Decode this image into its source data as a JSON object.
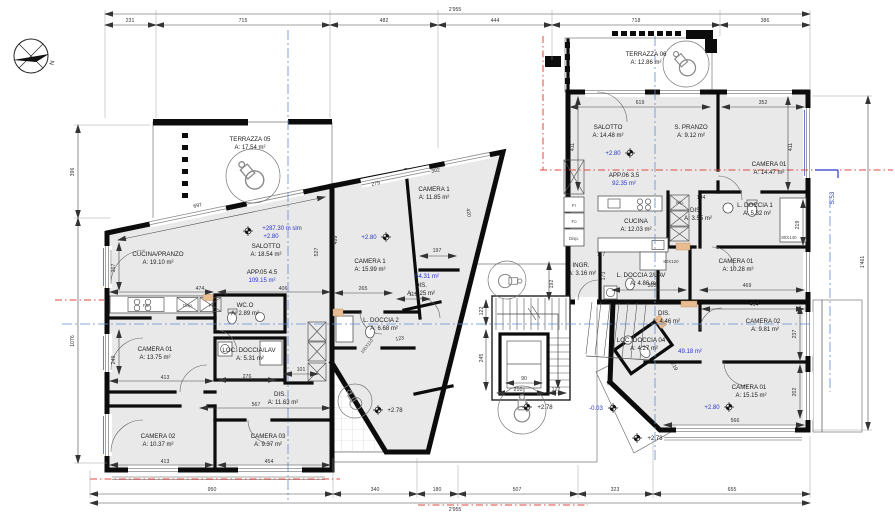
{
  "compass": {
    "north": "N"
  },
  "section": {
    "label": "S.53"
  },
  "overall": {
    "top": "2'955",
    "bottom": "2'955",
    "right": "1'461"
  },
  "dims_top": [
    "231",
    "715",
    "482",
    "444",
    "718",
    "386"
  ],
  "dims_bottom": [
    "950",
    "340",
    "180",
    "507",
    "323",
    "655"
  ],
  "dims_left": [
    "396",
    "1076"
  ],
  "idims": [
    "474",
    "406",
    "697",
    "527",
    "499",
    "413",
    "276",
    "101",
    "567",
    "413",
    "454",
    "279",
    "302",
    "420",
    "197",
    "265",
    "119",
    "123",
    "192",
    "245",
    "122",
    "90",
    "210",
    "122",
    "619",
    "352",
    "411",
    "411",
    "104",
    "117",
    "173",
    "305",
    "469",
    "219",
    "414",
    "237",
    "566",
    "202",
    "219",
    "249",
    "367"
  ],
  "sizes": [
    "80X140",
    "80X120",
    "100X110"
  ],
  "app05": {
    "terrazza": {
      "name": "TERRAZZA 05",
      "area": "A:    17.54 m²"
    },
    "cucina_pranzo": {
      "name": "CUCINA/PRANZO",
      "area": "A:        19.10 m²"
    },
    "salotto": {
      "name": "SALOTTO",
      "area": "A: 18.54 m²"
    },
    "unit_label": "APP.05  4.5",
    "unit_area": "109.15 m²",
    "wc": {
      "name": "WC.O",
      "area": "A: 2.89 m²"
    },
    "loc_doccia": {
      "name": "LOC. DOCCIA/LAV",
      "area": "A:    5.31 m²"
    },
    "camera01": {
      "name": "CAMERA 01",
      "area": "A:  13.75 m²"
    },
    "dis": {
      "name": "DIS.",
      "area": "A: 11.63 m²"
    },
    "camera02": {
      "name": "CAMERA 02",
      "area": "A:  10.37 m²"
    },
    "camera03": {
      "name": "CAMERA 03",
      "area": "A:  9.37 m²"
    },
    "kitchen": [
      "Fo.",
      "Disp.",
      "Fr"
    ]
  },
  "mid": {
    "camera1_top": {
      "name": "CAMERA 1",
      "area": "A: 11.85 m²"
    },
    "camera1_left": {
      "name": "CAMERA 1",
      "area": "A: 15.99 m²"
    },
    "unit_area": "54.31 m²",
    "dis": {
      "name": "DIS.",
      "area": "A: 4.25 m²"
    },
    "doccia": {
      "name": "L. DOCCIA 2",
      "area": "A:    6.68 m²"
    }
  },
  "app06": {
    "terrazza": {
      "name": "TERRAZZA 06",
      "area": "A:    12.86 m²"
    },
    "salotto": {
      "name": "SALOTTO",
      "area": "A: 14.48 m²"
    },
    "s_pranzo": {
      "name": "S. PRANZO",
      "area": "A:    9.12 m²"
    },
    "camera01_top": {
      "name": "CAMERA 01",
      "area": "A:   14.47 m²"
    },
    "unit_label": "APP.06  3.5",
    "unit_area": "92.35 m²",
    "cucina": {
      "name": "CUCINA",
      "area": "A: 12.03 m²"
    },
    "dis": {
      "name": "DIS.",
      "area": "A: 3.55 m²"
    },
    "doccia1": {
      "name": "L. DOCCIA 1",
      "area": "A:    5.32 m²"
    },
    "camera01_mid": {
      "name": "CAMERA 01",
      "area": "A:   10.28 m²"
    },
    "ingr": {
      "name": "INGR.",
      "area": "A: 3.16 m²"
    },
    "doccia2": {
      "name": "L. DOCCIA 2/LAV",
      "area": "A:    4.86 m²"
    },
    "kitchen": [
      "Fr",
      "Fo",
      "Disp."
    ],
    "rip": "Rip."
  },
  "app07": {
    "dis": {
      "name": "DIS.",
      "area": "A: 4.46 m²"
    },
    "camera02": {
      "name": "CAMERA 02",
      "area": "A:    9.81 m²"
    },
    "loc_doccia": {
      "name": "LOC. DOCCIA 04",
      "area": "A:        4.27 m²"
    },
    "unit_area": "49.18 m²",
    "camera01": {
      "name": "CAMERA 01",
      "area": "A:   15.15 m²"
    }
  },
  "levels": {
    "main": "+287.30 m slm",
    "l05": "+2.80",
    "lmid": "+2.80",
    "l06": "+2.80",
    "l07": "+2.80",
    "c1": "+2.78",
    "c2": "-0.03",
    "c3": "+2.78",
    "c4": "+2.78"
  }
}
